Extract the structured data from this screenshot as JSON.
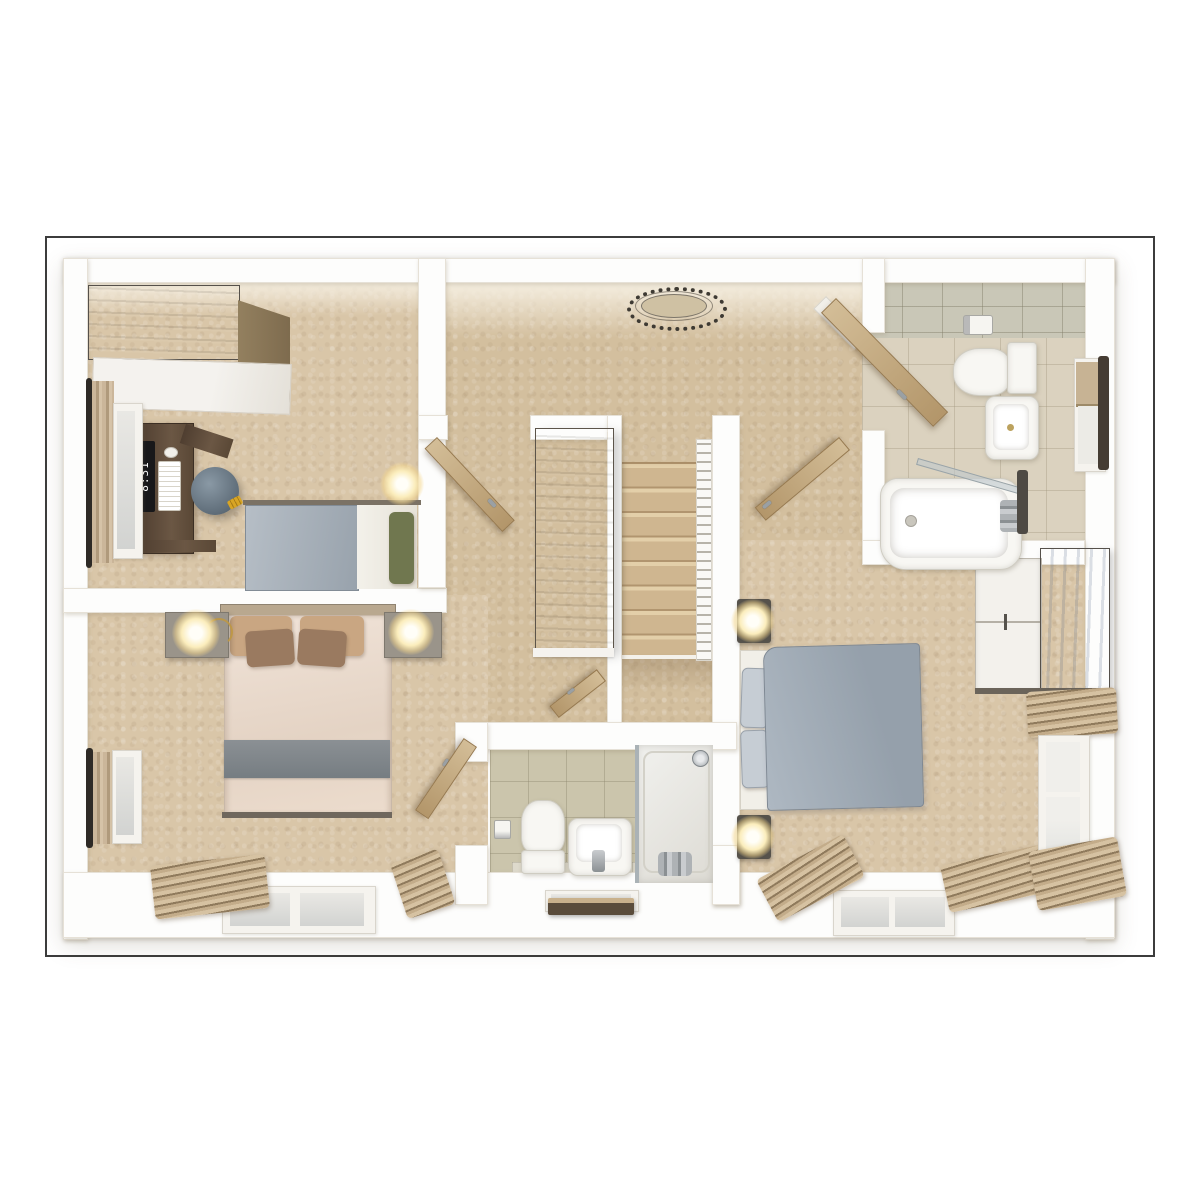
{
  "scene": {
    "type": "3d-floor-plan-render",
    "view": "top-down dollhouse cutaway",
    "style": "photorealistic architectural visualization",
    "floor": "upper floor with three bedrooms, landing, family bathroom and en-suite"
  },
  "frame": {
    "border_color": "#3c3c3c",
    "background": "#ffffff"
  },
  "palette": {
    "carpet": "#d9c6a8",
    "hall_carpet": "#d3bf9e",
    "wall": "#fdfdfc",
    "door_wood": "#c0a173",
    "dark_wood": "#6d665b",
    "gray_bedding": "#a3adb7",
    "cream_bedding": "#ecdccd",
    "bath_tile": "#dbd2bf",
    "ensuite_tile": "#cbc5ac",
    "lamp_glow": "#fbedbc"
  },
  "monitor": {
    "screen_text": "8:31"
  },
  "rooms": [
    {
      "id": "bedroom-2",
      "label": "Bedroom top left",
      "furniture": [
        "wardrobe",
        "desk",
        "monitor",
        "keyboard",
        "mouse",
        "stool",
        "single-bed",
        "green-pillow",
        "bedside-lamp",
        "window",
        "curtain"
      ]
    },
    {
      "id": "landing",
      "label": "Landing and hallway",
      "furniture": [
        "ceiling-light",
        "staircase",
        "banister",
        "tall-cupboard",
        "doors"
      ]
    },
    {
      "id": "family-bathroom",
      "label": "Family bathroom top right",
      "furniture": [
        "toilet",
        "toilet-roll-holder",
        "basin",
        "bathtub",
        "shower-screen",
        "bath-taps",
        "towel-rail",
        "window",
        "roller-blind",
        "door"
      ]
    },
    {
      "id": "master-bedroom",
      "label": "Master bedroom bottom left",
      "furniture": [
        "double-bed",
        "headboard",
        "pillows",
        "gray-throw",
        "nightstand-left",
        "nightstand-right",
        "bedside-lamps",
        "windows",
        "curtains",
        "door"
      ]
    },
    {
      "id": "en-suite",
      "label": "En-suite shower room",
      "furniture": [
        "toilet",
        "toilet-roll-holder",
        "basin",
        "shower-enclosure",
        "shower-head",
        "mixer-taps",
        "bath-mat",
        "window",
        "door"
      ]
    },
    {
      "id": "bedroom-3",
      "label": "Bedroom bottom right",
      "furniture": [
        "double-bed",
        "pillows",
        "bedside-lamps",
        "wardrobe",
        "windows",
        "curtains",
        "door"
      ]
    }
  ]
}
